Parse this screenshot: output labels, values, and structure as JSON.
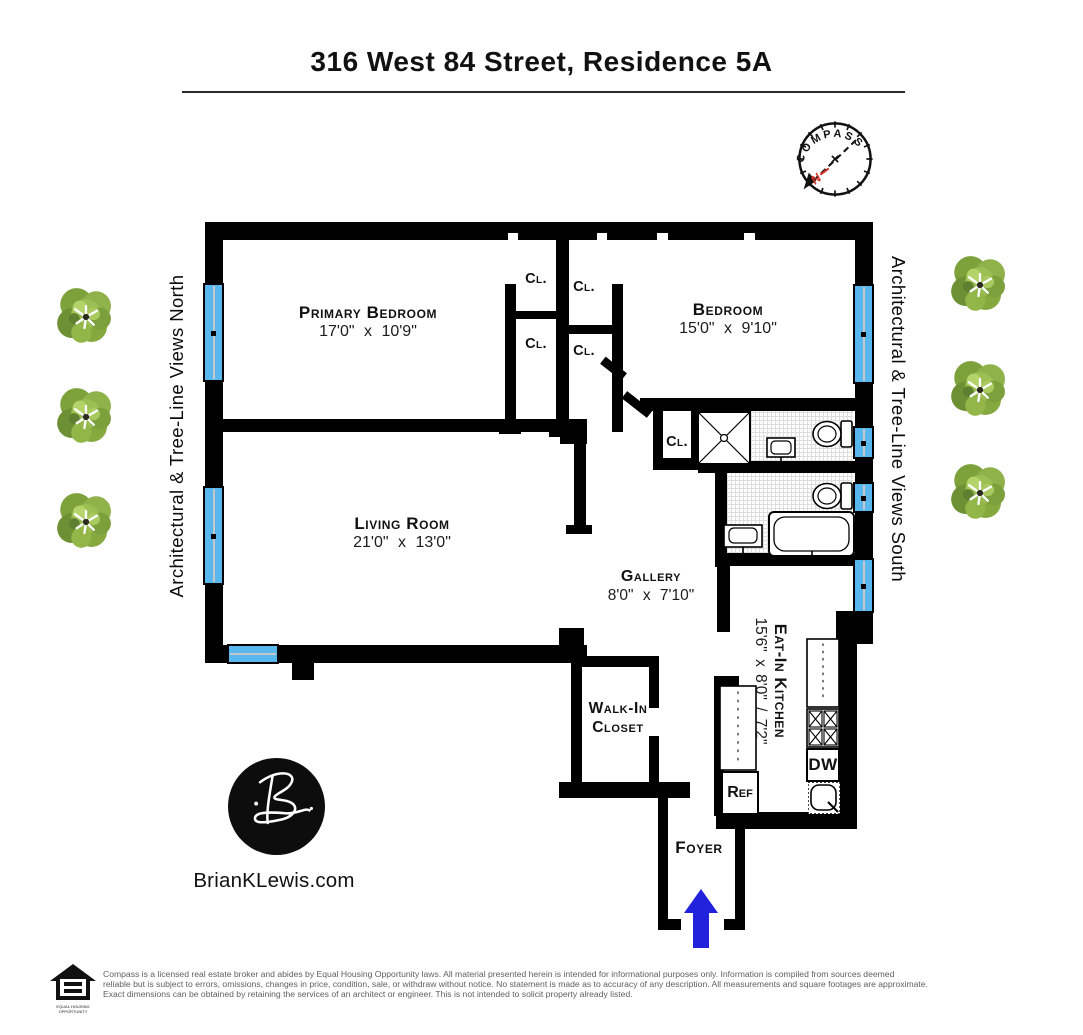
{
  "title": "316 West 84 Street, Residence 5A",
  "compass": {
    "label": "COMPASS",
    "north_letter": "N"
  },
  "side_views": {
    "north": "Architectural & Tree-Line Views North",
    "south": "Architectural & Tree-Line Views South"
  },
  "rooms": {
    "primary": {
      "name": "Primary Bedroom",
      "dims": "17'0\" x 10'9\""
    },
    "bedroom": {
      "name": "Bedroom",
      "dims": "15'0\" x 9'10\""
    },
    "living": {
      "name": "Living Room",
      "dims": "21'0\" x 13'0\""
    },
    "gallery": {
      "name": "Gallery",
      "dims": "8'0\" x 7'10\""
    },
    "kitchen": {
      "name": "Eat-In Kitchen",
      "dims": "15'6\" x 8'0\" / 7'2\""
    },
    "walk_in_closet": {
      "name": "Walk-In Closet"
    },
    "foyer": {
      "name": "Foyer"
    },
    "closet_abbr": "Cl."
  },
  "appliances": {
    "refrigerator": "Ref",
    "dishwasher": "DW"
  },
  "branding": {
    "website": "BrianKLewis.com",
    "logo_monogram": "B"
  },
  "footer": {
    "lines": [
      "Compass is a licensed real estate broker and abides by Equal Housing Opportunity laws. All material presented herein is intended for informational purposes only. Information is compiled from sources deemed",
      "reliable but is subject to errors, omissions, changes in price, condition, sale, or withdraw without notice. No statement is made as to accuracy of any description. All measurements and square footages are approximate.",
      "Exact dimensions can be obtained by retaining the services of an architect or engineer. This is not intended to solicit property already listed."
    ],
    "equal_housing_caption": "EQUAL HOUSING OPPORTUNITY"
  },
  "colors": {
    "wall_black": "#000000",
    "window_blue": "#58b7ef",
    "entry_arrow_blue": "#2222dd",
    "compass_north_red": "#d93025",
    "tree_green": "#86a93f"
  }
}
